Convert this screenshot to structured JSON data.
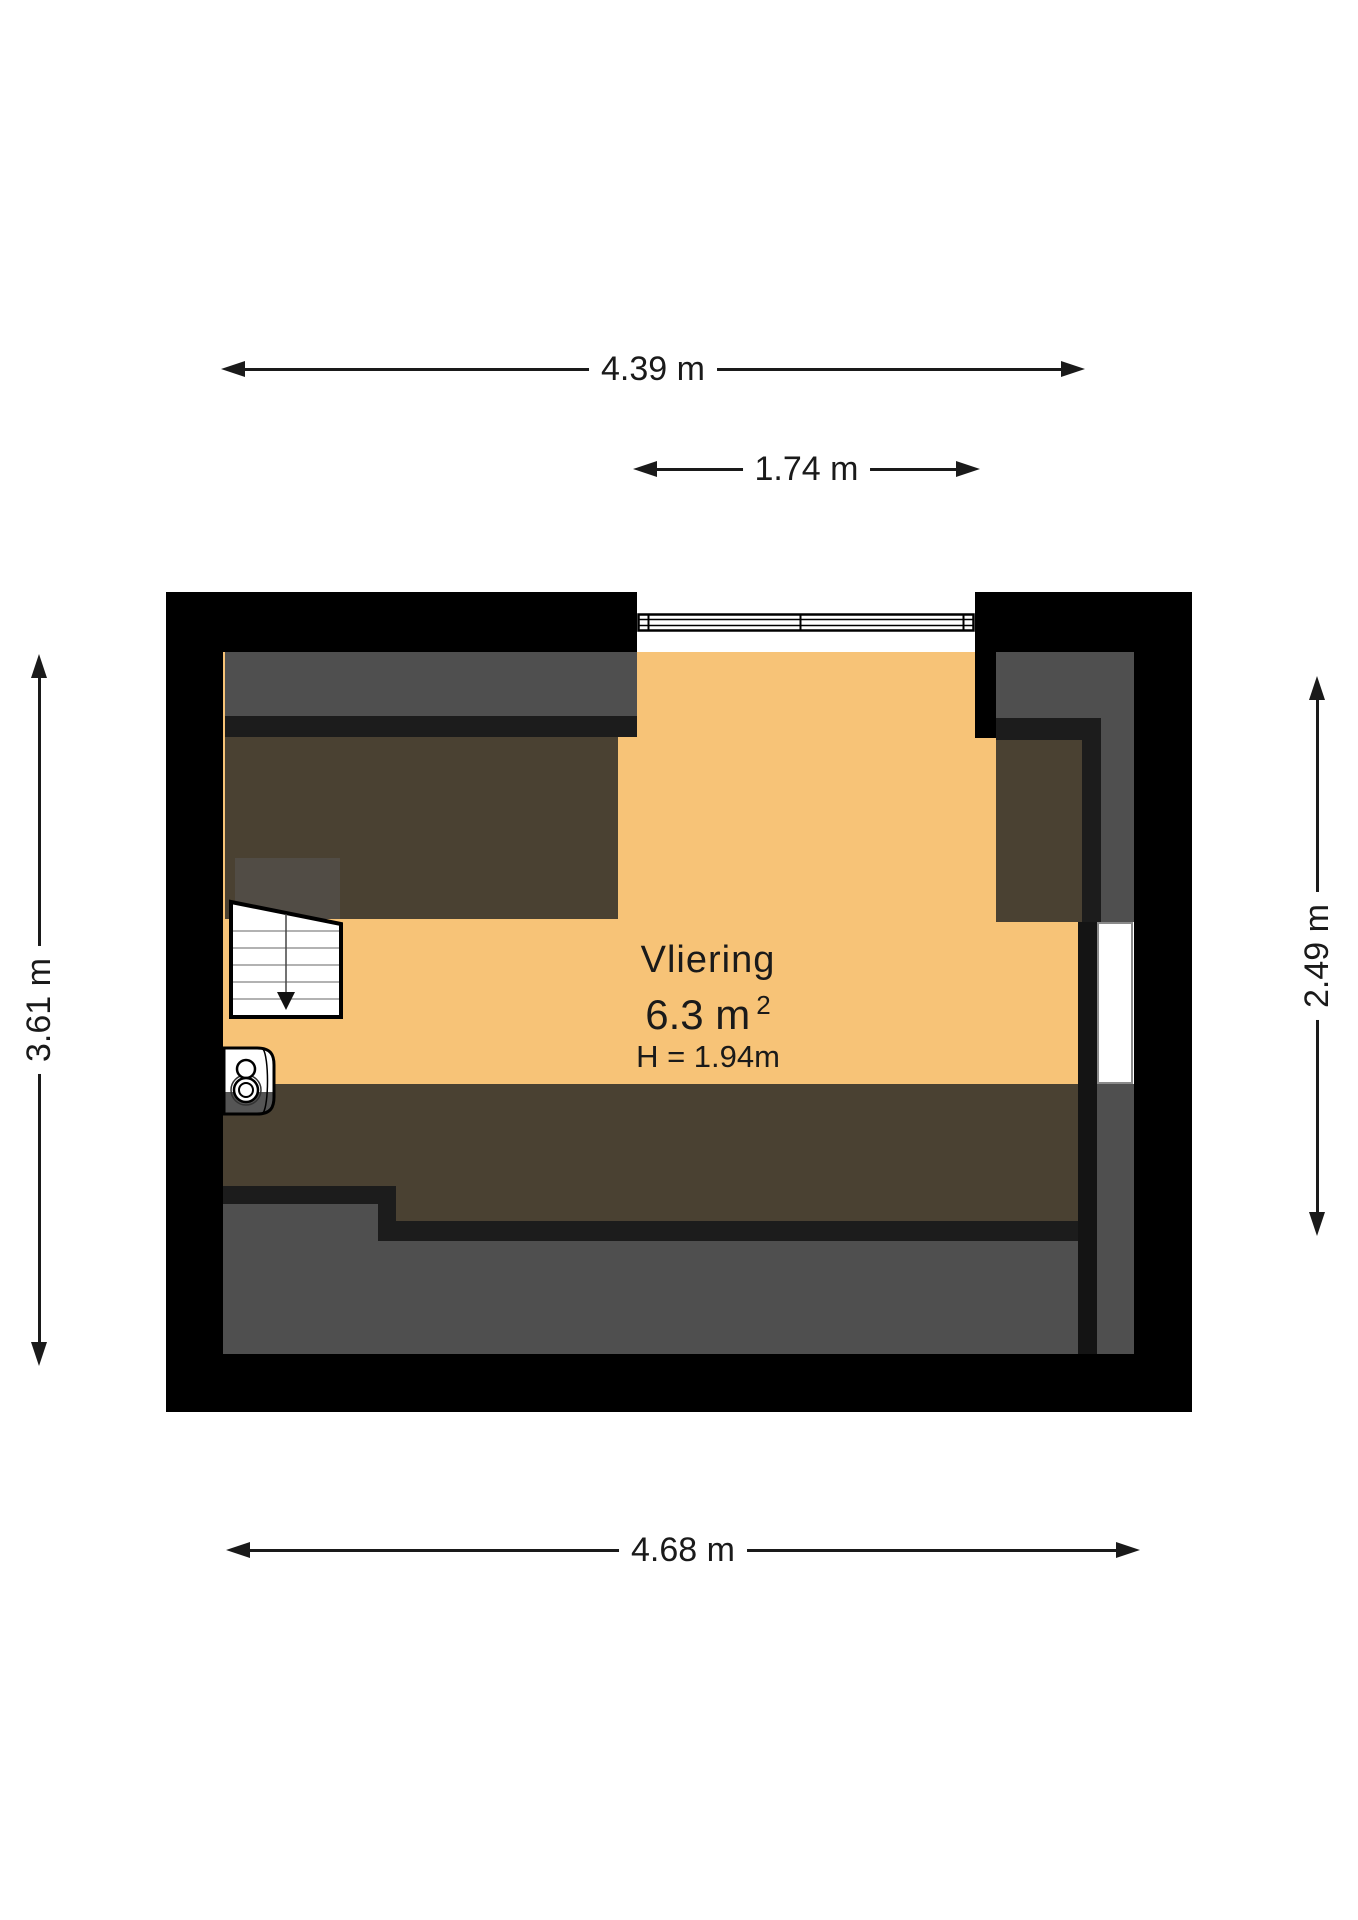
{
  "room": {
    "name": "Vliering",
    "area_value": "6.3 m",
    "area_sup": "2",
    "height_label": "H = 1.94m"
  },
  "dimensions": {
    "top": {
      "label": "4.39 m"
    },
    "top_inner": {
      "label": "1.74 m"
    },
    "left": {
      "label": "3.61 m"
    },
    "right": {
      "label": "2.49 m"
    },
    "bottom": {
      "label": "4.68 m"
    }
  },
  "icons": {
    "stairs": "stairs-down-icon",
    "boiler": "water-heater-icon",
    "window": "window-icon",
    "opening": "wall-opening"
  },
  "colors": {
    "page": "#ffffff",
    "text": "#1a1a1a",
    "wall": "#000000",
    "innerwall": "#141414",
    "orange": "#f7c377",
    "brown": "#4a4132",
    "gray": "#4f4f4f",
    "dark": "#1c1c1c",
    "stairs_patch": "#514c45",
    "boiler_gray": "#555555",
    "door_border": "#8a8a8a",
    "stair_line": "#999999"
  }
}
